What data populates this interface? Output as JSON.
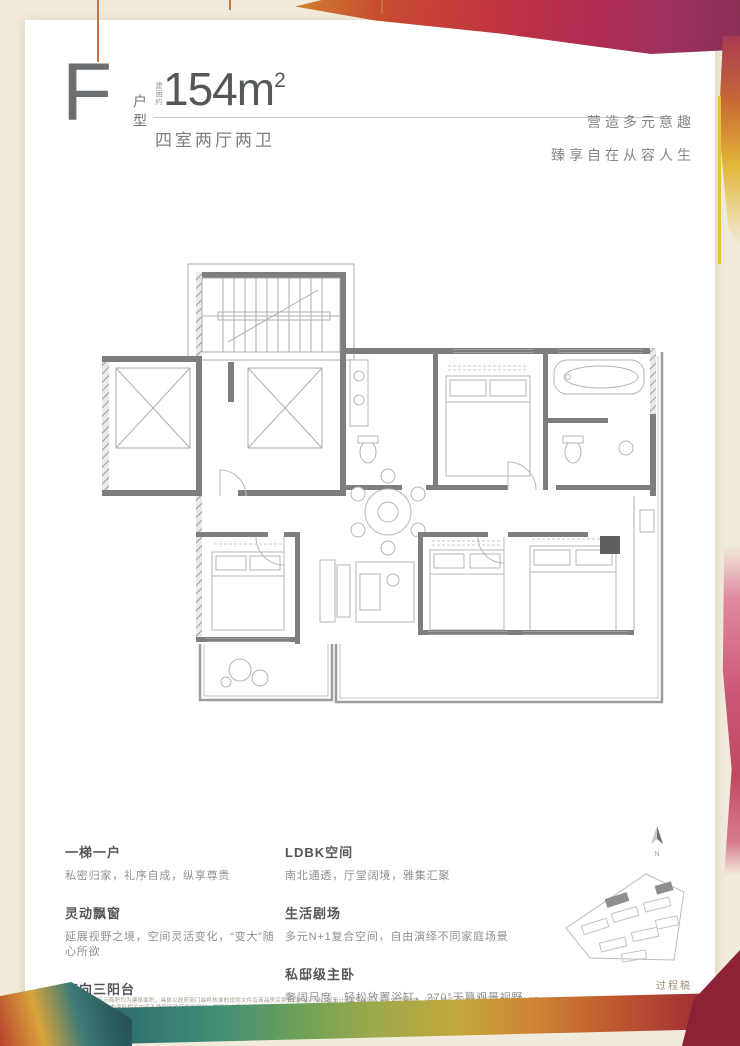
{
  "colors": {
    "page_bg": "#f1ebdb",
    "card_bg": "#ffffff",
    "text_dark": "#55585a",
    "text_gray": "#85888a",
    "wall_gray": "#7e7e7e",
    "accent_orange": "#c27340",
    "splash_red": "#c03440",
    "splash_magenta": "#b22b52",
    "strip_teal": "#3f8d78",
    "strip_maroon": "#8d2136",
    "yellow": "#e6c33c"
  },
  "header": {
    "unit_letter": "F",
    "unit_type_label": "户型",
    "area_prefix": "建面约",
    "area_value": "154m",
    "area_superscript": "2",
    "layout_description": "四室两厅两卫",
    "tagline_line1": "营造多元意趣",
    "tagline_line2": "臻享自在从容人生"
  },
  "features": {
    "left": [
      {
        "title": "一梯一户",
        "desc": "私密归家，礼序自成，纵享尊贵"
      },
      {
        "title": "灵动飘窗",
        "desc": "延展视野之境，空间灵活变化，“变大”随心所欲"
      },
      {
        "title": "南向三阳台",
        "desc": "采光视野佳，延展生活的无限可能"
      }
    ],
    "right": [
      {
        "title": "LDBK空间",
        "desc": "南北通透，厅堂阔境，雅集汇聚"
      },
      {
        "title": "生活剧场",
        "desc": "多元N+1复合空间，自由演绎不同家庭场景"
      },
      {
        "title": "私邸级主卧",
        "desc": "奢阔尺度，轻松放置浴缸，270°天幕观景视野"
      }
    ]
  },
  "compass": {
    "north_label": "N"
  },
  "footer": {
    "draft_label": "过程稿",
    "disclaimer_line1": "本户型图仅为示意图，所示面积均为建筑面积，具体以政府部门最终核准的规划文件及商品房买卖合同约定为准。因设计调整等原因，实际交付的墙体、门窗、管道、设备等位置可能与本图存在差异，相关家具、饰品、绿化仅为示意，不代表最终交付标准，交付标准以买卖合同约定为准。",
    "disclaimer_line2": "本资料相关内容不排除因政府相关规划、规定及出卖人未能控制的原因而发生变化，敬请留意最新资料。出卖人保留对本宣传资料的解释权，详细信息请至销售现场咨询了解。"
  }
}
